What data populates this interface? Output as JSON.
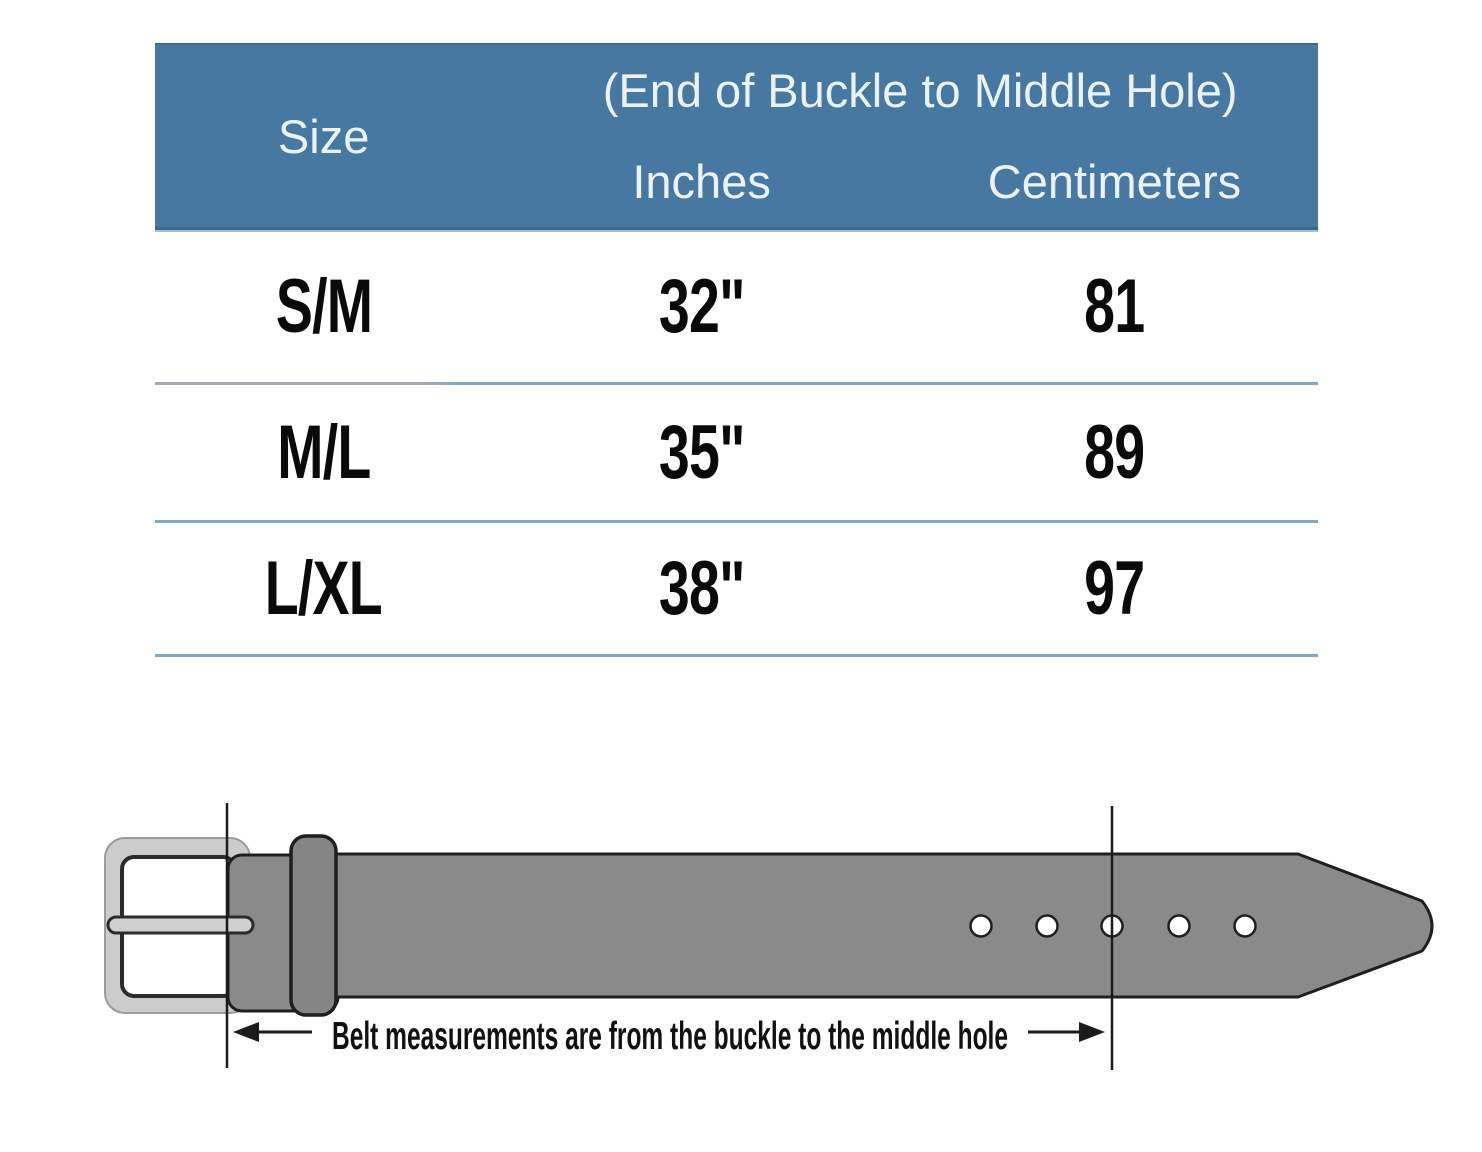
{
  "table": {
    "header": {
      "size_label": "Size",
      "span_label": "(End of Buckle to Middle Hole)",
      "inches_label": "Inches",
      "centimeters_label": "Centimeters"
    },
    "rows": [
      {
        "size": "S/M",
        "inches": "32\"",
        "cm": "81"
      },
      {
        "size": "M/L",
        "inches": "35\"",
        "cm": "89"
      },
      {
        "size": "L/XL",
        "inches": "38\"",
        "cm": "97"
      }
    ]
  },
  "diagram": {
    "caption": "Belt measurements are from the buckle to the middle hole"
  },
  "chart_data": {
    "type": "table",
    "title": "(End of Buckle to Middle Hole)",
    "columns": [
      "Size",
      "Inches",
      "Centimeters"
    ],
    "rows": [
      [
        "S/M",
        "32\"",
        "81"
      ],
      [
        "M/L",
        "35\"",
        "89"
      ],
      [
        "L/XL",
        "38\"",
        "97"
      ]
    ],
    "annotation": "Belt measurements are from the buckle to the middle hole"
  },
  "colors": {
    "header_bg": "#4678a2",
    "header_text": "#eaf2f8",
    "divider": "#7fa6cb",
    "strap": "#8a8a8a",
    "keeper": "#858585",
    "buckle_frame": "#cccccc",
    "prong": "#cfcfcf",
    "outline": "#1f1f1f",
    "hole_fill": "#ffffff"
  }
}
